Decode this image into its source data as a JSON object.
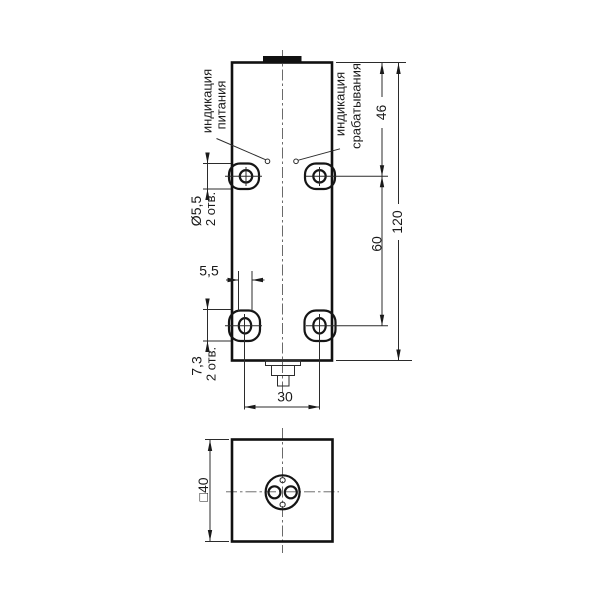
{
  "drawing": {
    "type": "technical-dimension-drawing",
    "views": [
      "front-view",
      "bottom-view"
    ],
    "labels": {
      "power1": "индикация",
      "power2": "питания",
      "output1": "индикация",
      "output2": "срабатывания"
    },
    "dims": {
      "hole_dia": "Ø5,5",
      "hole_dia_qty": "2 отв.",
      "slot_len": "7,3",
      "slot_len_qty": "2 отв.",
      "slot_width": "5,5",
      "holes_h_spacing": "30",
      "top_to_hole": "46",
      "holes_v_spacing": "60",
      "height": "120",
      "square": "□40"
    },
    "colors": {
      "outline": "#111111",
      "dimension_lines": "#2b2b2b",
      "background": "#ffffff"
    }
  }
}
